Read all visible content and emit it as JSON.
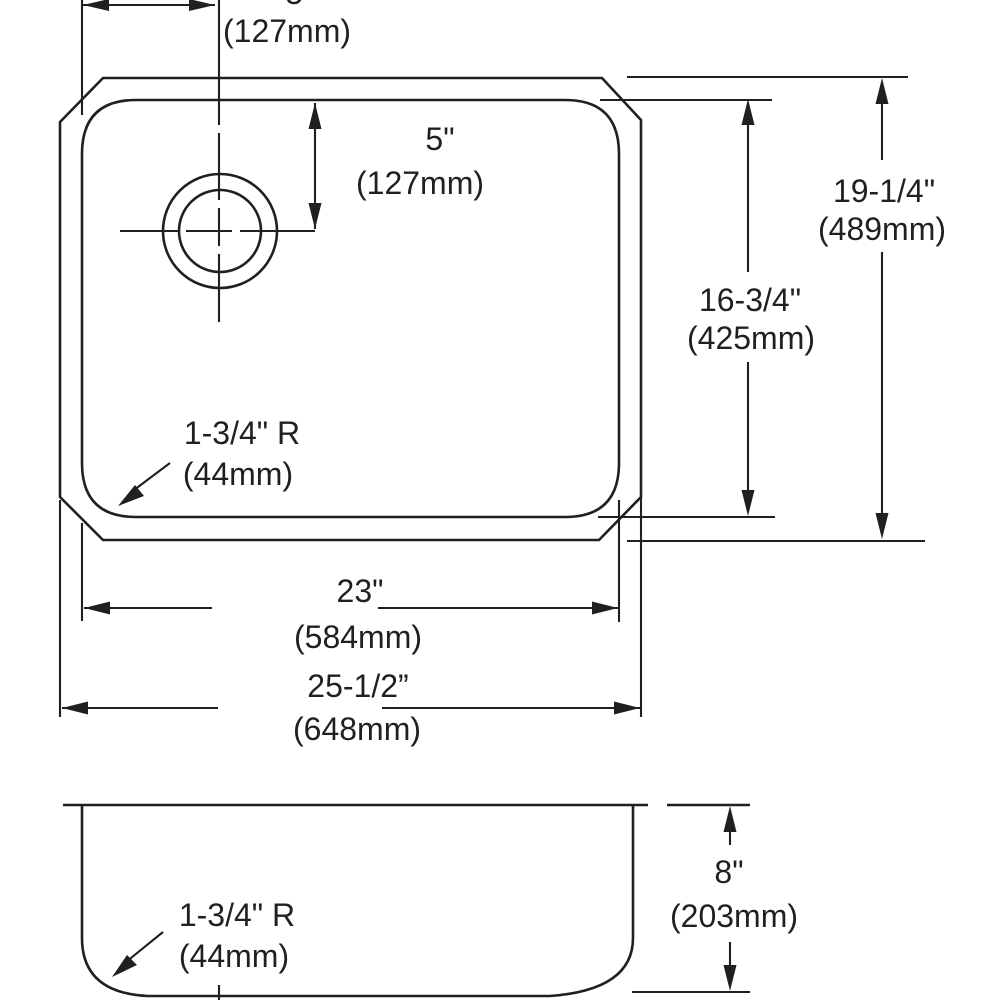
{
  "drawing": {
    "type": "sink technical dimension drawing",
    "colors": {
      "line": "#231f20",
      "background": "#ffffff"
    },
    "top_view": {
      "faucet_offset_dim": {
        "inches": "5\"",
        "mm": "(127mm)"
      },
      "faucet_setback_dim": {
        "inches": "5\"",
        "mm": "(127mm)"
      },
      "overall_length_dim": {
        "inches": "19-1/4\"",
        "mm": "(489mm)"
      },
      "bowl_length_dim": {
        "inches": "16-3/4\"",
        "mm": "(425mm)"
      },
      "corner_radius": {
        "label": "1-3/4\" R",
        "mm": "(44mm)"
      },
      "bowl_width_dim": {
        "inches": "23\"",
        "mm": "(584mm)"
      },
      "overall_width_dim": {
        "inches": "25-1/2”",
        "mm": "(648mm)"
      }
    },
    "side_view": {
      "bowl_height_dim": {
        "inches": "8\"",
        "mm": "(203mm)"
      },
      "corner_radius": {
        "label": "1-3/4\" R",
        "mm": "(44mm)"
      }
    }
  }
}
